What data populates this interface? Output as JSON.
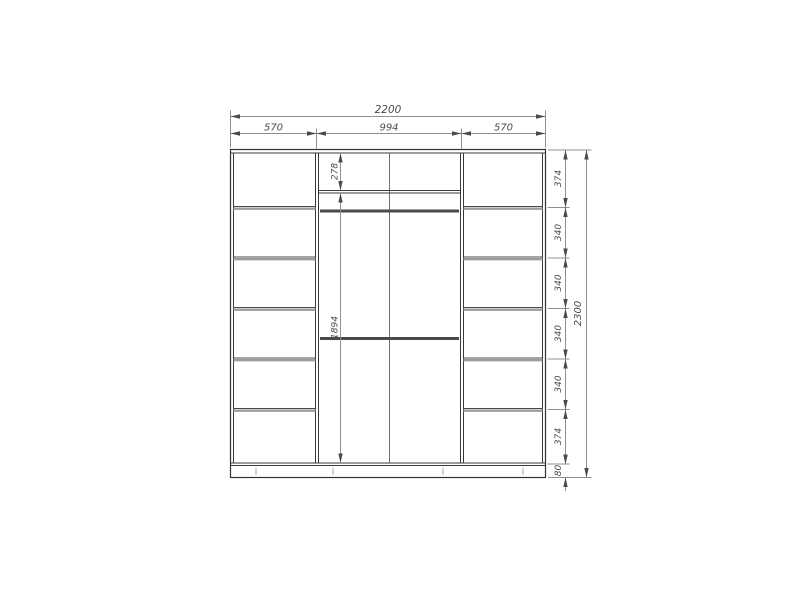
{
  "drawing": {
    "type": "furniture-technical-drawing",
    "subject": "wardrobe front elevation with dimension lines",
    "units": "mm",
    "dimensions": {
      "overall_width": "2200",
      "overall_height": "2300",
      "top_sections": [
        "570",
        "994",
        "570"
      ],
      "right_column": [
        "374",
        "340",
        "340",
        "340",
        "340",
        "374",
        "80"
      ],
      "middle_column": [
        "278",
        "1894"
      ]
    },
    "structure": {
      "left_shelf_compartments": 6,
      "right_shelf_compartments": 6,
      "middle_hanging_rods": 2,
      "middle_door_split": 1,
      "plinth": "80"
    },
    "colors": {
      "background": "#ffffff",
      "object_line": "#3a3a3a",
      "shelf_gray": "#9d9d9d",
      "rod": "#4a4a4a",
      "dimension_line": "#8f8f8f",
      "arrow": "#4a4a4a",
      "text": "#4a4a4a"
    }
  }
}
